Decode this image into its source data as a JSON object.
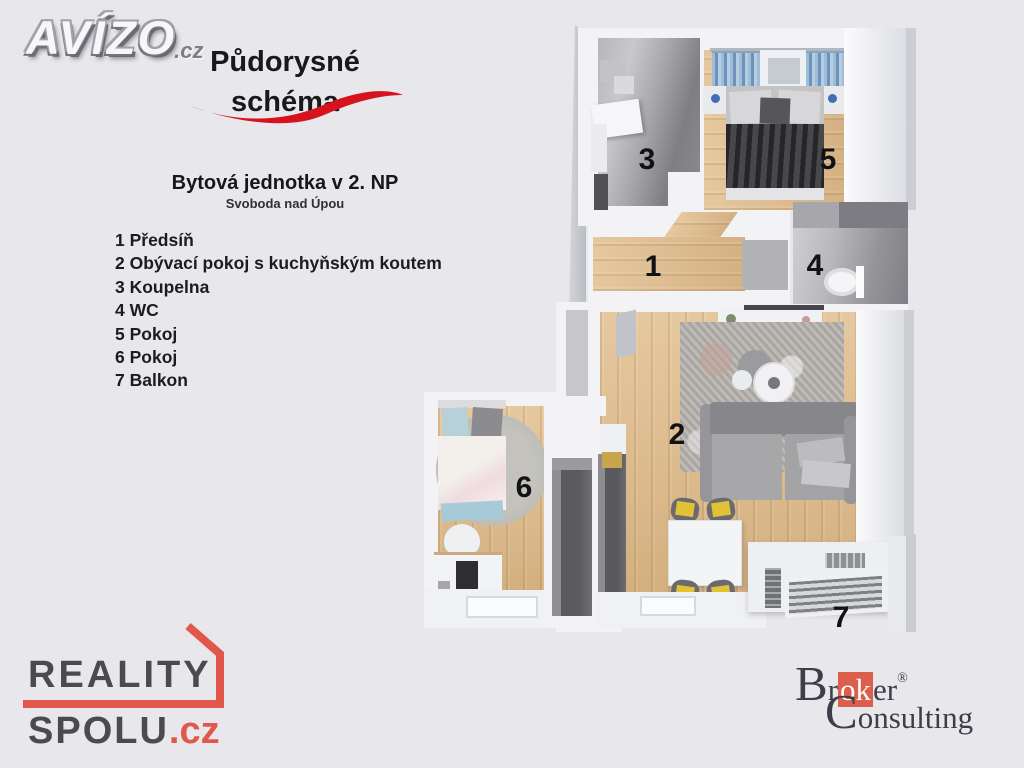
{
  "branding": {
    "avizo": {
      "name": "AVÍZO",
      "tld": ".cz"
    },
    "reality": {
      "word1": "REALITY",
      "word2": "SPOLU",
      "tld": ".cz",
      "accent_color": "#e2574c",
      "text_color": "#4b4b4f"
    },
    "broker": {
      "b": "B",
      "r": "r",
      "ok": "ok",
      "er": "er",
      "reg": "®",
      "c": "C",
      "rest": "onsulting",
      "accent_color": "#dc5f4d",
      "text_color": "#3e3e48"
    }
  },
  "header": {
    "title_line1": "Půdorysné",
    "title_line2": "schéma",
    "swoosh_color": "#d6121f"
  },
  "unit": {
    "name": "Bytová jednotka v 2. NP",
    "location": "Svoboda nad Úpou"
  },
  "legend": {
    "items": [
      "1 Předsíň",
      "2 Obývací pokoj s kuchyňským koutem",
      "3 Koupelna",
      "4 WC",
      "5 Pokoj",
      "6 Pokoj",
      "7 Balkon"
    ]
  },
  "plan": {
    "labels": {
      "hall": "1",
      "living": "2",
      "bathroom": "3",
      "wc": "4",
      "bedroom": "5",
      "room": "6",
      "balcony": "7"
    }
  },
  "colors": {
    "background": "#e8e8ec",
    "wall": "#f3f3f6",
    "wood": "#ddbd93",
    "concrete": "#9a9a9e",
    "label": "#121216"
  }
}
